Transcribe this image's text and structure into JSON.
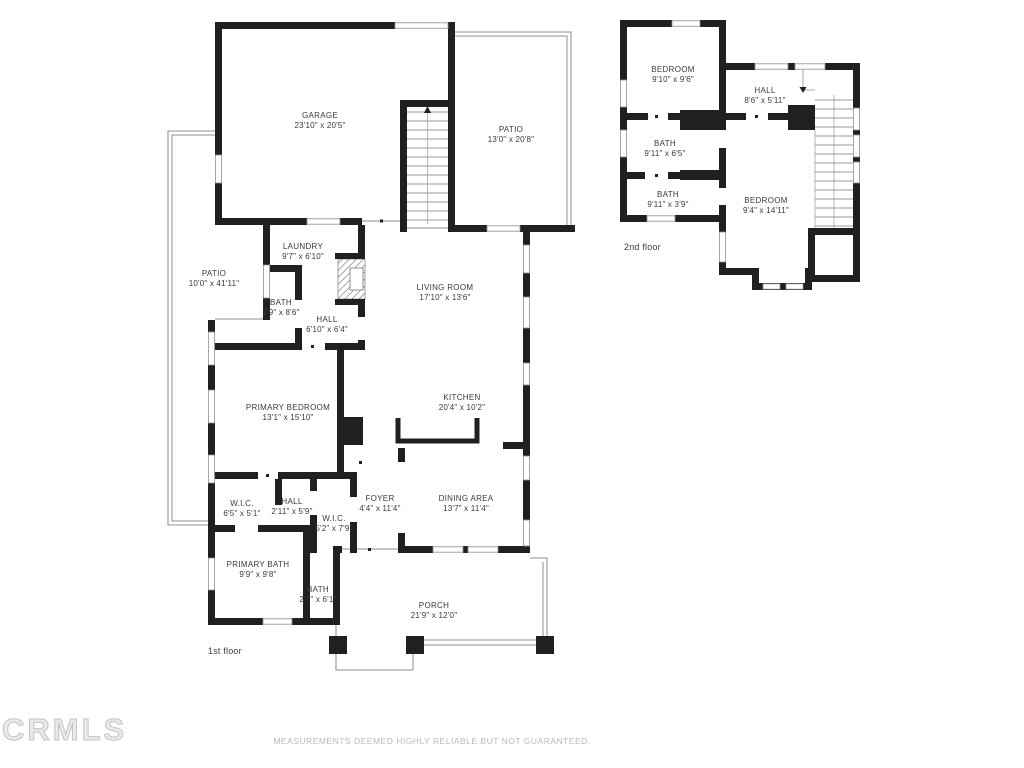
{
  "watermark": "CRMLS",
  "disclaimer": "MEASUREMENTS DEEMED HIGHLY RELIABLE BUT NOT GUARANTEED.",
  "colors": {
    "wall": "#202020",
    "thin_line": "#8f8f8f",
    "label_text": "#3a3a3a",
    "muted_text": "#b5b9c1"
  },
  "floors": {
    "first": {
      "label": "1st floor",
      "rooms": [
        {
          "name": "GARAGE",
          "dims": "23'10\" x 20'5\""
        },
        {
          "name": "PATIO",
          "dims": "13'0\" x 20'8\""
        },
        {
          "name": "PATIO",
          "dims": "10'0\" x 41'11\""
        },
        {
          "name": "LAUNDRY",
          "dims": "9'7\" x 6'10\""
        },
        {
          "name": "BATH",
          "dims": "2'9\" x 8'6\""
        },
        {
          "name": "HALL",
          "dims": "6'10\" x 6'4\""
        },
        {
          "name": "LIVING ROOM",
          "dims": "17'10\" x 13'6\""
        },
        {
          "name": "PRIMARY BEDROOM",
          "dims": "13'1\" x 15'10\""
        },
        {
          "name": "KITCHEN",
          "dims": "20'4\" x 10'2\""
        },
        {
          "name": "W.I.C.",
          "dims": "6'5\" x 5'1\""
        },
        {
          "name": "HALL",
          "dims": "2'11\" x 5'9\""
        },
        {
          "name": "W.I.C.",
          "dims": "5'2\" x 7'9\""
        },
        {
          "name": "FOYER",
          "dims": "4'4\" x 11'4\""
        },
        {
          "name": "DINING AREA",
          "dims": "13'7\" x 11'4\""
        },
        {
          "name": "PRIMARY BATH",
          "dims": "9'9\" x 9'8\""
        },
        {
          "name": "BATH",
          "dims": "2'7\" x 6'1\""
        },
        {
          "name": "PORCH",
          "dims": "21'9\" x 12'0\""
        }
      ]
    },
    "second": {
      "label": "2nd floor",
      "rooms": [
        {
          "name": "BEDROOM",
          "dims": "9'10\" x 9'6\""
        },
        {
          "name": "HALL",
          "dims": "8'6\" x 5'11\""
        },
        {
          "name": "BATH",
          "dims": "9'11\" x 6'5\""
        },
        {
          "name": "BATH",
          "dims": "9'11\" x 3'9\""
        },
        {
          "name": "BEDROOM",
          "dims": "9'4\" x 14'11\""
        }
      ]
    }
  }
}
